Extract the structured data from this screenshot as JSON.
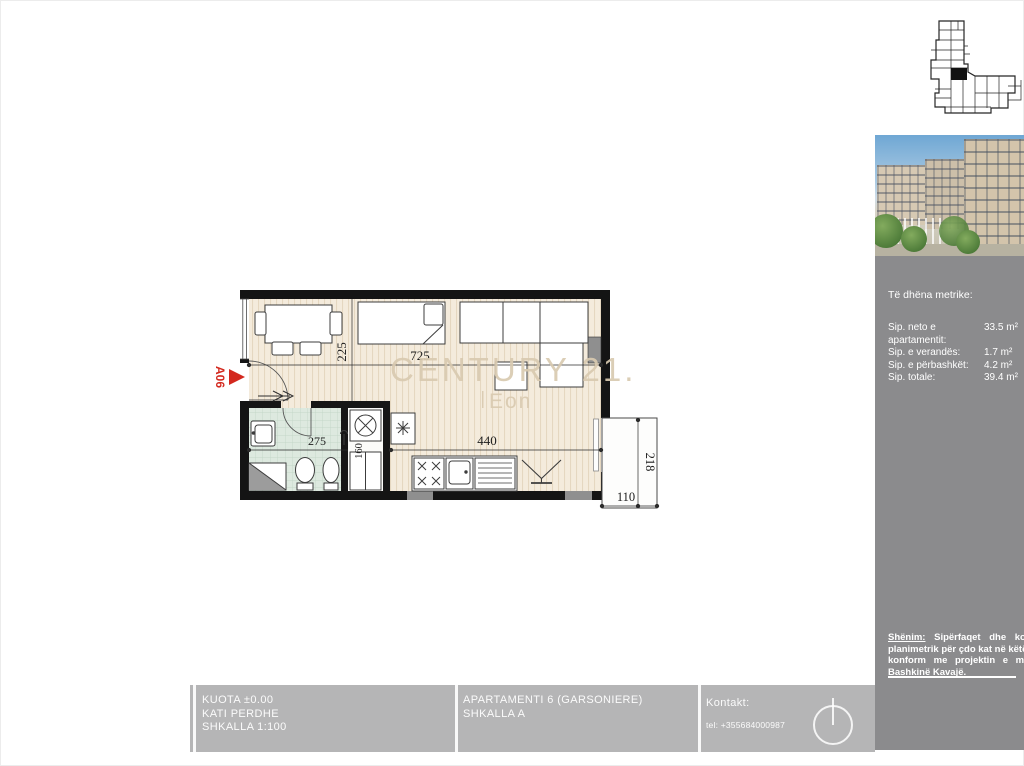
{
  "plan": {
    "unit_label": "A06",
    "watermark": {
      "brand": "CENTURY 21.",
      "sub": "Eon"
    },
    "dims": {
      "room_width": "725",
      "room_height": "225",
      "kitchen_width": "440",
      "bath_width": "275",
      "closet_depth": "160",
      "veranda_height": "218",
      "veranda_width": "110"
    }
  },
  "sidebar": {
    "metrics": {
      "title": "Të dhëna metrike:",
      "rows": [
        {
          "label": "Sip. neto e apartamentit:",
          "value": "33.5 m²"
        },
        {
          "label": "Sip. e verandës:",
          "value": "1.7 m²"
        },
        {
          "label": "Sip. e përbashkët:",
          "value": "4.2 m²"
        },
        {
          "label": "Sip. totale:",
          "value": "39.4 m²"
        }
      ]
    },
    "note": {
      "label": "Shënim:",
      "line1_rest": "Sipërfaqet dhe konfigu",
      "lines": [
        "planimetrik për çdo kat në këtë album ë",
        "konform me projektin e miratuar",
        "Bashkinë Kavajë."
      ]
    }
  },
  "footer": {
    "block1": [
      "KUOTA ±0.00",
      "KATI PERDHE",
      "SHKALLA 1:100"
    ],
    "block2": [
      "APARTAMENTI 6 (GARSONIERE)",
      "SHKALLA A"
    ],
    "contact_label": "Kontakt:",
    "contact_tel": "tel: +355684000987"
  },
  "colors": {
    "accent_red": "#d3281e",
    "watermark": "#d9cab0",
    "sidebar_bg": "#8b8b8d",
    "footer_bg": "#b5b5b6"
  }
}
